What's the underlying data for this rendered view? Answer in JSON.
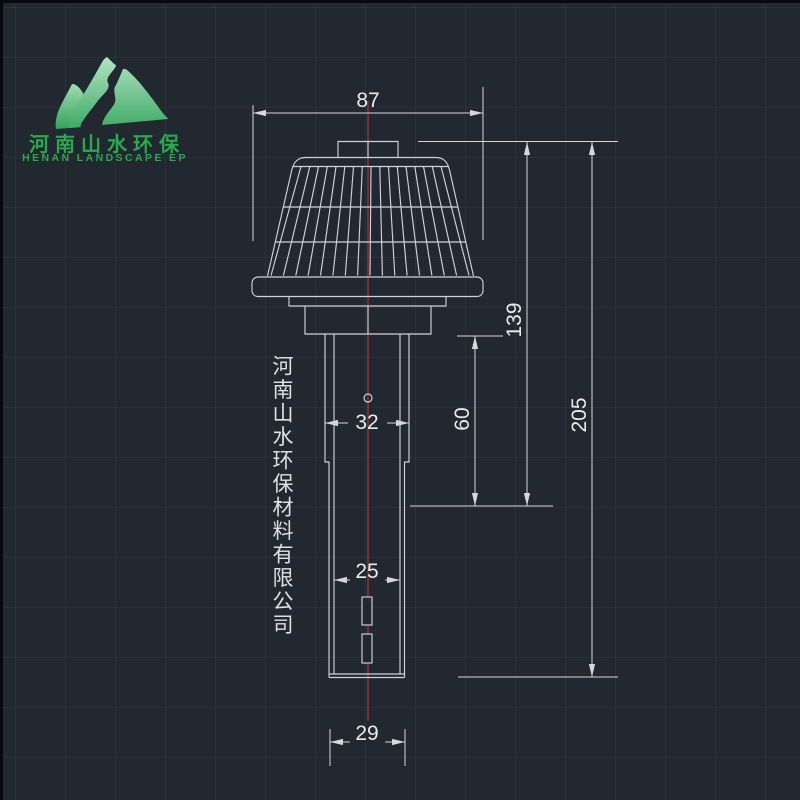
{
  "logo": {
    "company_zh": "河南山水环保",
    "company_en": "HENAN LANDSCAPE EP",
    "accent_green": "#2aa84f"
  },
  "watermark": {
    "company_vertical": "河南山水环保材料有限公司"
  },
  "dimensions": {
    "cap_width": "87",
    "cap_to_step_height": "139",
    "overall_height": "205",
    "lower_section_height": "60",
    "stem_outer_diameter": "32",
    "bore_diameter": "25",
    "tip_diameter": "29"
  },
  "colors": {
    "canvas_bg": "#212830",
    "grid_line": "#2a313a",
    "geometry_line": "#cdd3da",
    "centerline_red": "#b03434",
    "dim_text": "#e8ebee"
  }
}
